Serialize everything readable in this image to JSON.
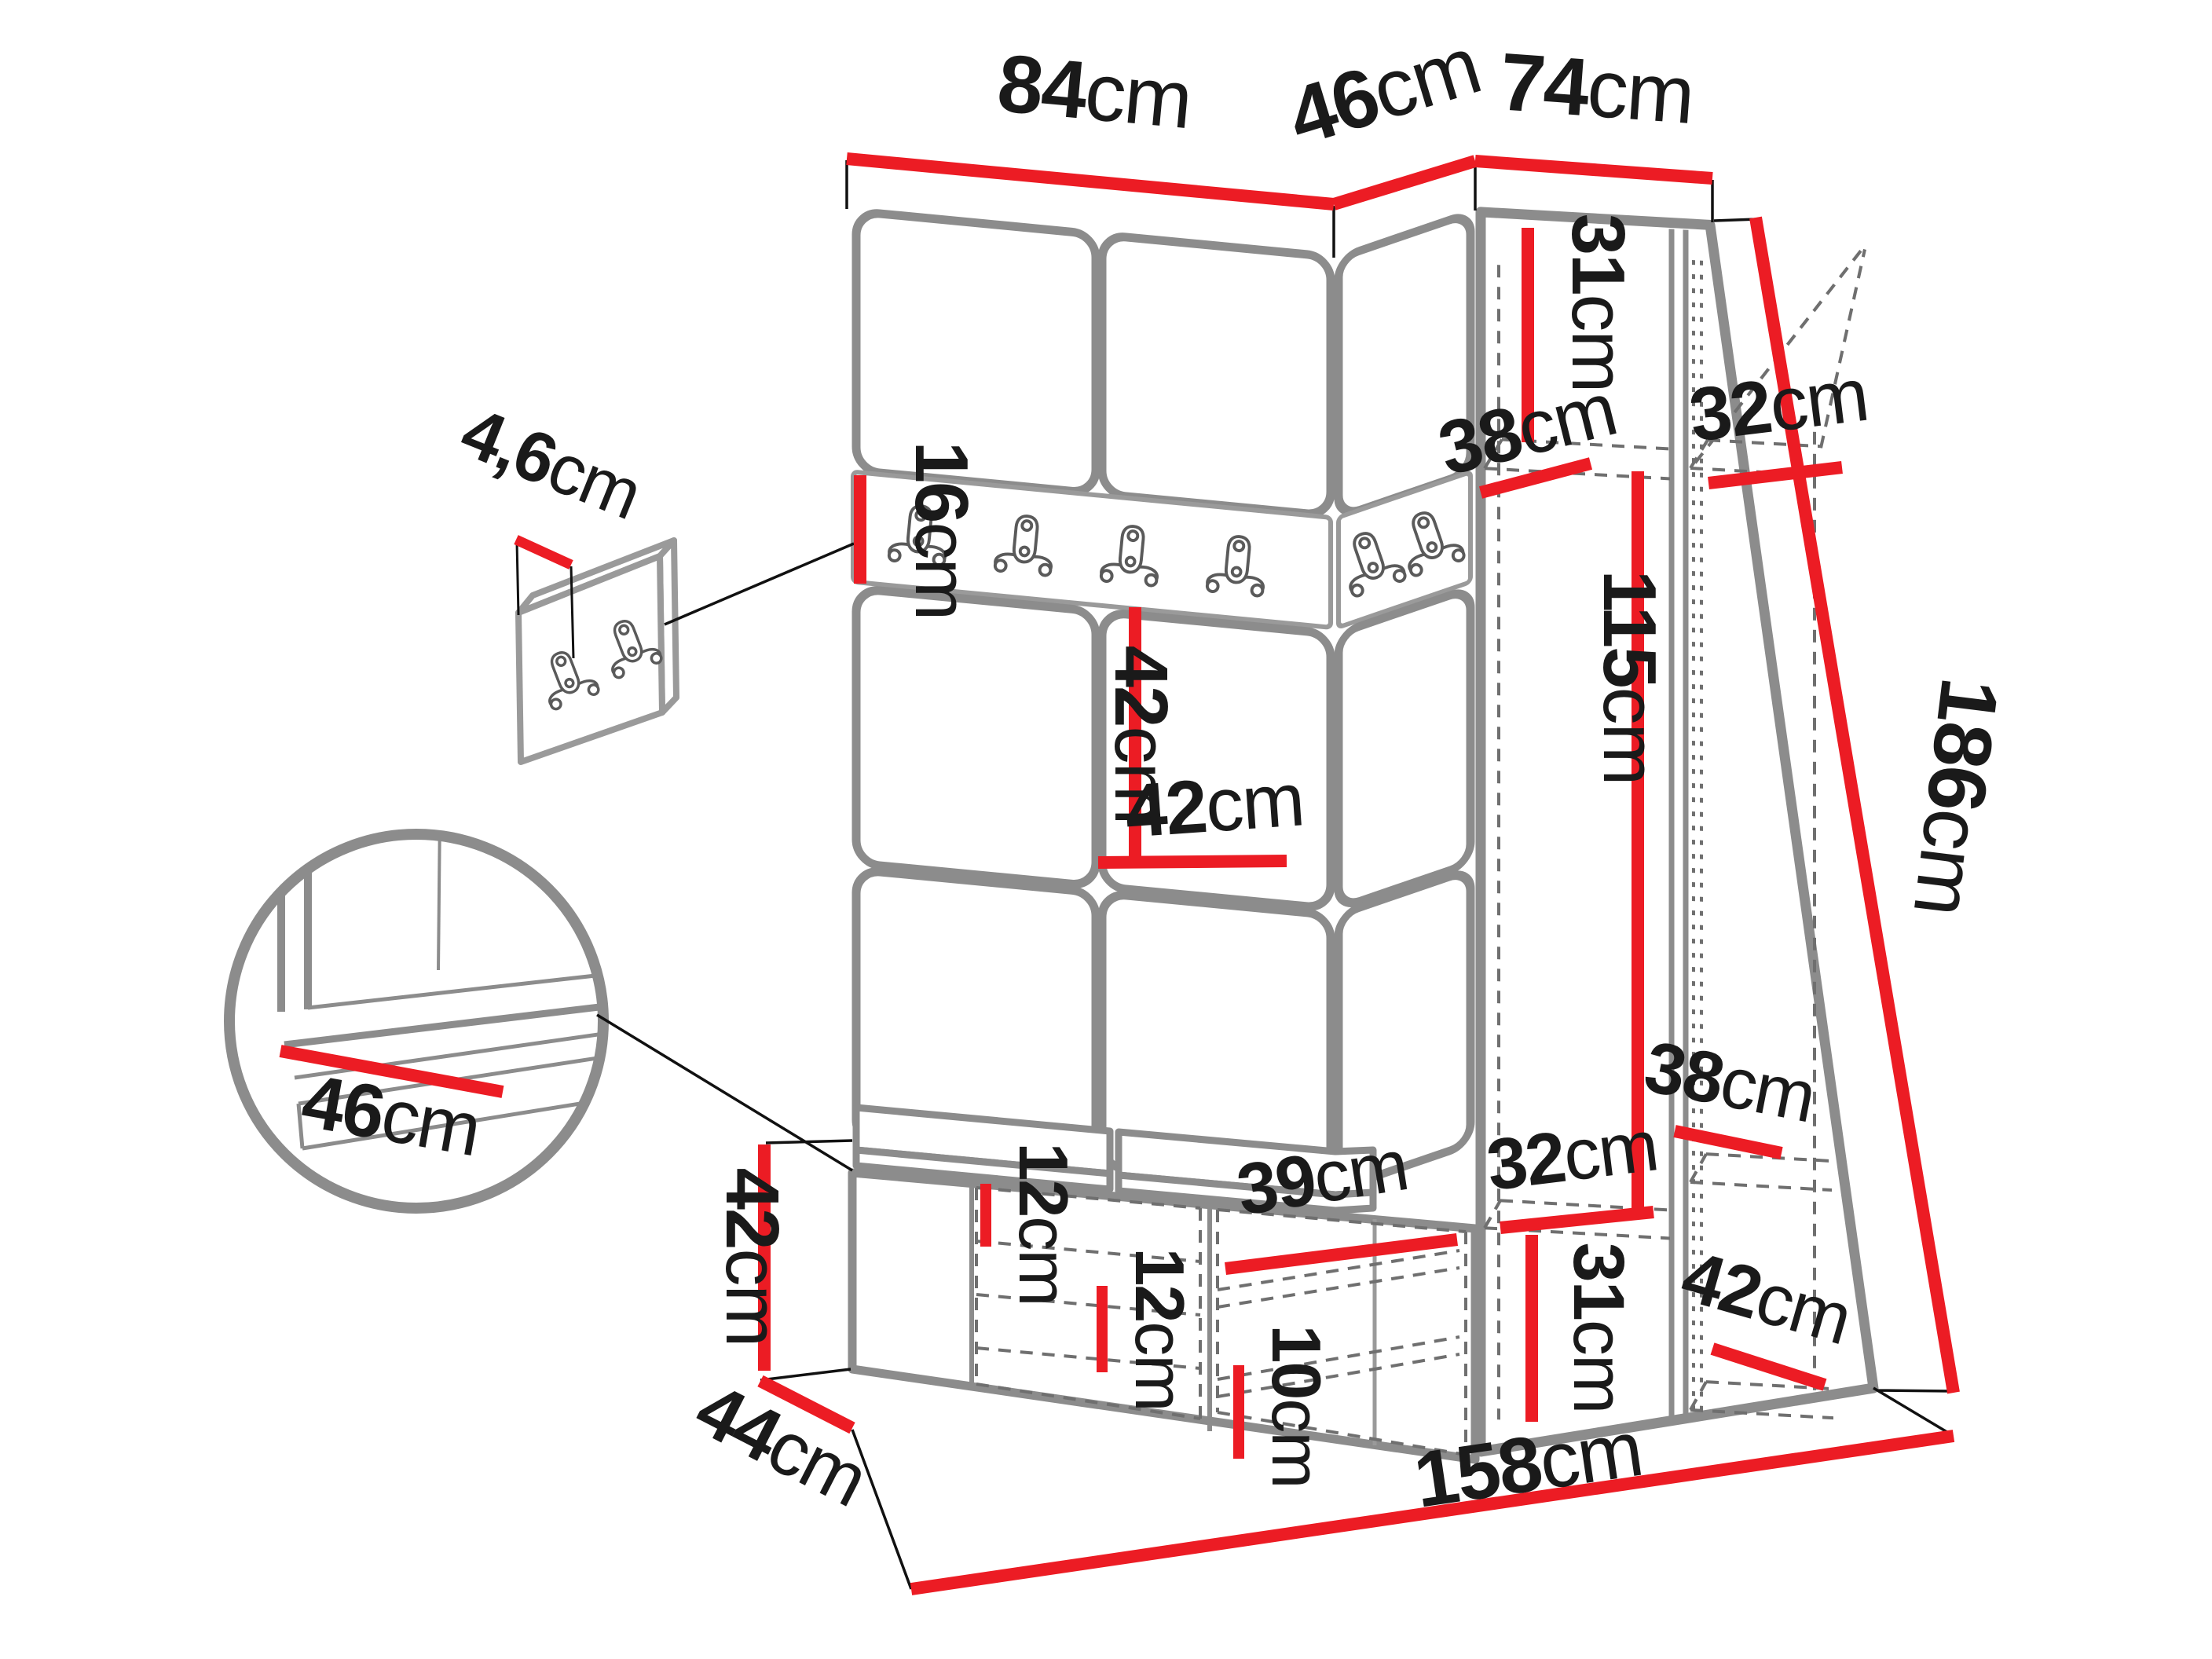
{
  "diagram": {
    "title": "hallway-furniture-dimension-diagram",
    "unit": "cm",
    "colors": {
      "dimension": "#ec1c24",
      "furniture": "#8c8c8c",
      "text": "#1a1a1a"
    },
    "labels": {
      "top_width_left": {
        "num": "84",
        "unit": "cm"
      },
      "top_width_corner": {
        "num": "46",
        "unit": "cm"
      },
      "top_width_right": {
        "num": "74",
        "unit": "cm"
      },
      "panel_thickness": {
        "num": "4,6",
        "unit": "cm"
      },
      "rail_height": {
        "num": "16",
        "unit": "cm"
      },
      "top_shelf_height": {
        "num": "31",
        "unit": "cm"
      },
      "top_shelf_depth": {
        "num": "38",
        "unit": "cm"
      },
      "top_shelf_width": {
        "num": "32",
        "unit": "cm"
      },
      "panel_row_height": {
        "num": "42",
        "unit": "cm"
      },
      "panel_width": {
        "num": "42",
        "unit": "cm"
      },
      "hanging_height": {
        "num": "115",
        "unit": "cm"
      },
      "total_height": {
        "num": "186",
        "unit": "cm"
      },
      "seat_depth_detail": {
        "num": "46",
        "unit": "cm"
      },
      "bench_height": {
        "num": "42",
        "unit": "cm"
      },
      "bench_depth": {
        "num": "44",
        "unit": "cm"
      },
      "shoe_space_upper": {
        "num": "12",
        "unit": "cm"
      },
      "shoe_space_lower": {
        "num": "12",
        "unit": "cm"
      },
      "shoe_shelf_width": {
        "num": "39",
        "unit": "cm"
      },
      "shoe_space_small": {
        "num": "10",
        "unit": "cm"
      },
      "lower_shelf_width": {
        "num": "32",
        "unit": "cm"
      },
      "lower_shelf_height": {
        "num": "31",
        "unit": "cm"
      },
      "lower_shelf_depth": {
        "num": "38",
        "unit": "cm"
      },
      "lower_shelf_depth2": {
        "num": "42",
        "unit": "cm"
      },
      "total_width": {
        "num": "158",
        "unit": "cm"
      }
    }
  }
}
